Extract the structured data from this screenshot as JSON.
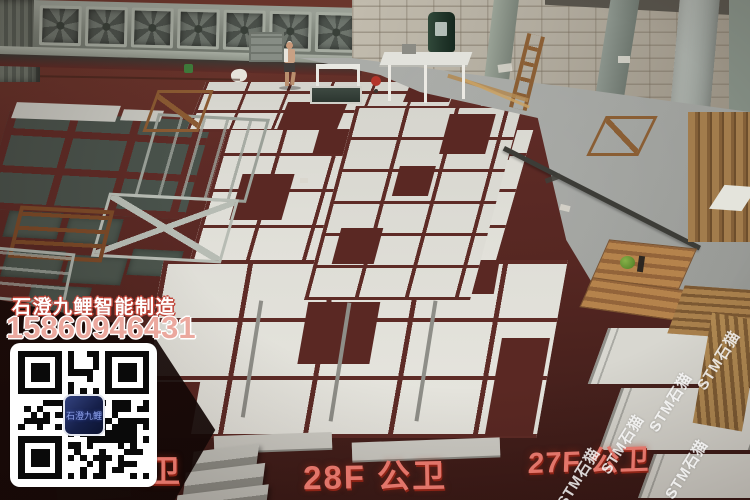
{
  "overlay": {
    "brand": "石澄九鲤智能制造",
    "phone": "15860946431"
  },
  "qr": {
    "center_label": "石澄九鲤"
  },
  "floor_labels": {
    "left_partial": "公卫",
    "center": "28F 公卫",
    "right": "27F 公卫"
  },
  "watermark": {
    "icon_glyph": "⌂",
    "text": "STM石猫"
  },
  "colors": {
    "floor_red": "#5e2b26",
    "label_red": "#e2756a",
    "tile_white": "#e2e1da",
    "concrete_grey": "#a8aaa6",
    "brand_outline_red": "#bf4438",
    "phone_pink": "#eba89e"
  }
}
